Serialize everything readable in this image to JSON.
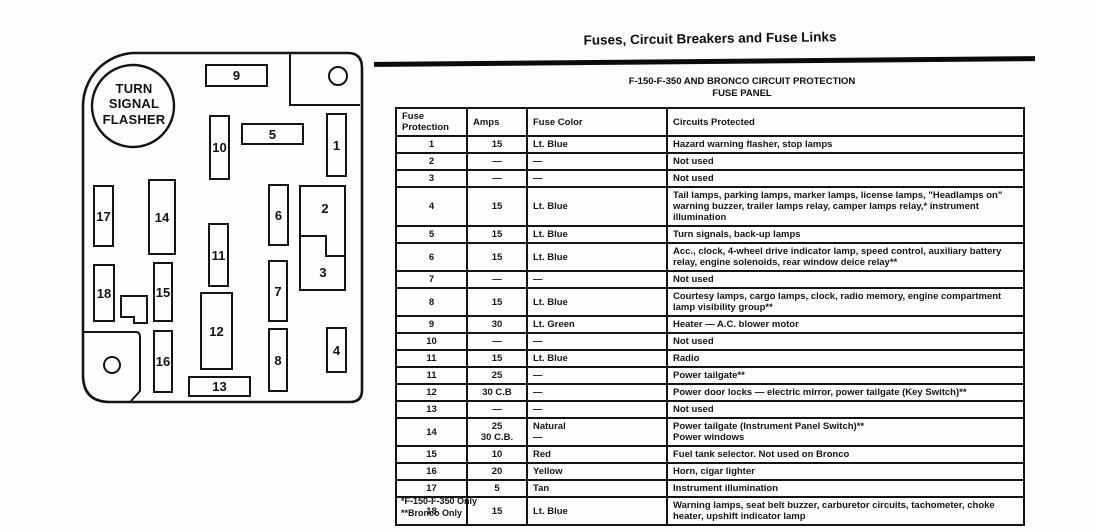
{
  "page": {
    "title": "Fuses, Circuit Breakers and Fuse Links",
    "subtitle_line1": "F-150-F-350 AND BRONCO CIRCUIT PROTECTION",
    "subtitle_line2": "FUSE PANEL",
    "footnote1": "*F-150-F-350 Only",
    "footnote2": "**Bronco Only"
  },
  "diagram": {
    "flasher_label": "TURN SIGNAL FLASHER",
    "fuses": [
      "1",
      "2",
      "3",
      "4",
      "5",
      "6",
      "7",
      "8",
      "9",
      "10",
      "11",
      "12",
      "13",
      "14",
      "15",
      "16",
      "17",
      "18"
    ]
  },
  "table": {
    "headers": {
      "fuse": "Fuse\nProtection",
      "amps": "Amps",
      "color": "Fuse Color",
      "circuits": "Circuits Protected"
    },
    "rows": [
      {
        "fuse": "1",
        "amps": "15",
        "color": "Lt. Blue",
        "circuits": "Hazard warning flasher, stop lamps"
      },
      {
        "fuse": "2",
        "amps": "—",
        "color": "—",
        "circuits": "Not used"
      },
      {
        "fuse": "3",
        "amps": "—",
        "color": "—",
        "circuits": "Not used"
      },
      {
        "fuse": "4",
        "amps": "15",
        "color": "Lt. Blue",
        "circuits": "Tail lamps, parking lamps, marker lamps, license lamps, \"Headlamps on\" warning buzzer, trailer lamps relay, camper lamps relay,* instrument illumination"
      },
      {
        "fuse": "5",
        "amps": "15",
        "color": "Lt. Blue",
        "circuits": "Turn signals, back-up lamps"
      },
      {
        "fuse": "6",
        "amps": "15",
        "color": "Lt. Blue",
        "circuits": "Acc., clock, 4-wheel drive indicator lamp, speed control, auxiliary battery relay, engine solenoids, rear window deice relay**"
      },
      {
        "fuse": "7",
        "amps": "—",
        "color": "—",
        "circuits": "Not used"
      },
      {
        "fuse": "8",
        "amps": "15",
        "color": "Lt. Blue",
        "circuits": "Courtesy lamps, cargo lamps, clock, radio memory, engine compartment lamp visibility group**"
      },
      {
        "fuse": "9",
        "amps": "30",
        "color": "Lt. Green",
        "circuits": "Heater — A.C. blower motor"
      },
      {
        "fuse": "10",
        "amps": "—",
        "color": "—",
        "circuits": "Not used"
      },
      {
        "fuse": "11",
        "amps": "15",
        "color": "Lt. Blue",
        "circuits": "Radio"
      },
      {
        "fuse": "11",
        "amps": "25",
        "color": "—",
        "circuits": "Power tailgate**"
      },
      {
        "fuse": "12",
        "amps": "30 C.B",
        "color": "—",
        "circuits": "Power door locks — electric mirror, power tailgate (Key Switch)**"
      },
      {
        "fuse": "13",
        "amps": "—",
        "color": "—",
        "circuits": "Not used"
      },
      {
        "fuse": "14",
        "amps": "25\n30 C.B.",
        "color": "Natural\n—",
        "circuits": "Power tailgate (Instrument Panel Switch)**\nPower windows"
      },
      {
        "fuse": "15",
        "amps": "10",
        "color": "Red",
        "circuits": "Fuel tank selector. Not used on Bronco"
      },
      {
        "fuse": "16",
        "amps": "20",
        "color": "Yellow",
        "circuits": "Horn, cigar lighter"
      },
      {
        "fuse": "17",
        "amps": "5",
        "color": "Tan",
        "circuits": "Instrument illumination"
      },
      {
        "fuse": "18",
        "amps": "15",
        "color": "Lt. Blue",
        "circuits": "Warning lamps, seat belt buzzer, carburetor circuits, tachometer, choke heater, upshift indicator lamp"
      }
    ]
  }
}
